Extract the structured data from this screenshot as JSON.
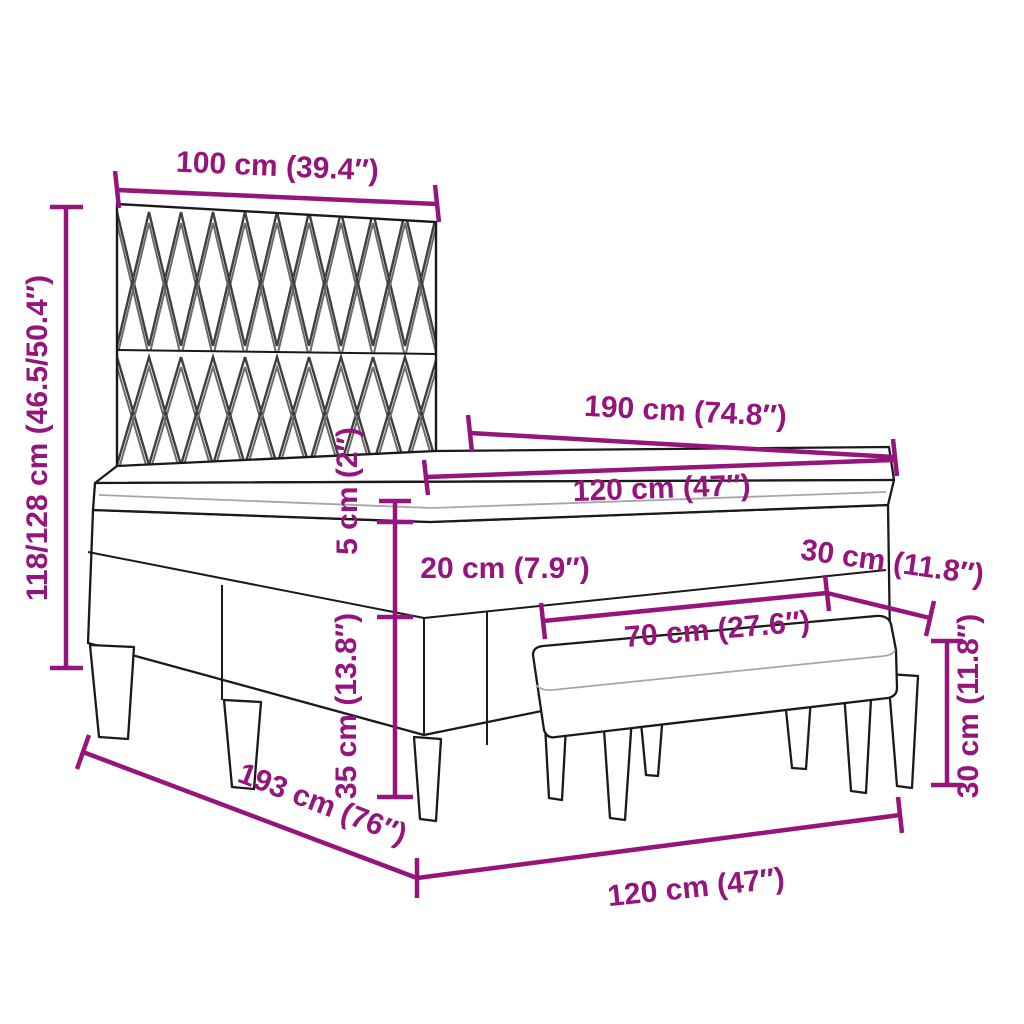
{
  "diagram": {
    "title": "Box spring bed with headboard, mattress topper and bench — dimension diagram",
    "colors": {
      "dimension_accent": "#95157d",
      "drawing_outline": "#1a1a1a",
      "background": "#ffffff",
      "headboard_pattern_line": "#3f3f3f",
      "soft_edge_gray": "#a6a6a6"
    },
    "labels": {
      "headboard_width": "100 cm (39.4″)",
      "bed_height": "118/128 cm (46.5/50.4″)",
      "mattress_length": "190 cm (74.8″)",
      "mattress_width_top": "120 cm (47″)",
      "topper_thickness": "5 cm (2″)",
      "mattress_thickness": "20 cm (7.9″)",
      "base_height": "35 cm (13.8″)",
      "bed_total_length": "193 cm (76″)",
      "bed_width_bottom": "120 cm (47″)",
      "bench_length": "70 cm (27.6″)",
      "bench_depth": "30 cm (11.8″)",
      "bench_height": "30 cm (11.8″)"
    }
  }
}
